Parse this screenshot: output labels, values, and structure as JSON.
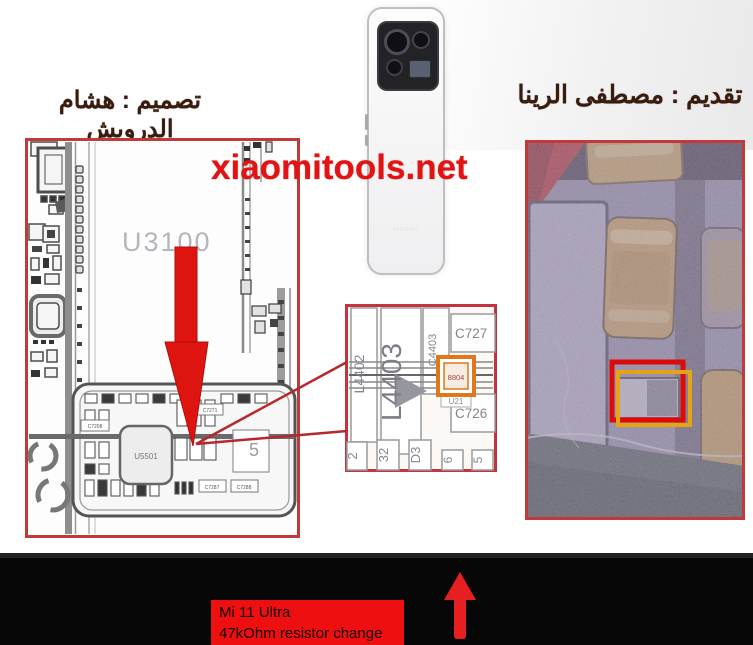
{
  "credits": {
    "design": "تصميم : هشام الدرويش",
    "presenter": "تقديم : مصطفى الرينا"
  },
  "watermark": {
    "text": "xiaomitools.net",
    "color": "#e11414"
  },
  "phone": {
    "brand_mark": "xiaomi"
  },
  "schematic": {
    "u3100": "U3100",
    "u5501": "U5501",
    "c7208": "C7208",
    "c7271": "C7271",
    "c7287": "C7287",
    "c7288": "C7288",
    "pad5": "5"
  },
  "zoom_box": {
    "l4402": "L4402",
    "l4403": "L4403",
    "c4403": "C4403",
    "c727": "C727",
    "c726": "C726",
    "u21": "U21",
    "resistor_label": "8804",
    "bottom_labels": [
      "2",
      "32",
      "D3",
      "6",
      "5"
    ]
  },
  "colors": {
    "panel_border_red": "#c0393b",
    "highlight_red": "#dd0a0a",
    "highlight_orange": "#e6a313",
    "arrow_red": "#de1411",
    "footer_label_bg": "#ee1010",
    "footer_arrow": "#e62020"
  },
  "footer": {
    "line1": "Mi 11 Ultra",
    "line2": "47kOhm resistor change"
  }
}
